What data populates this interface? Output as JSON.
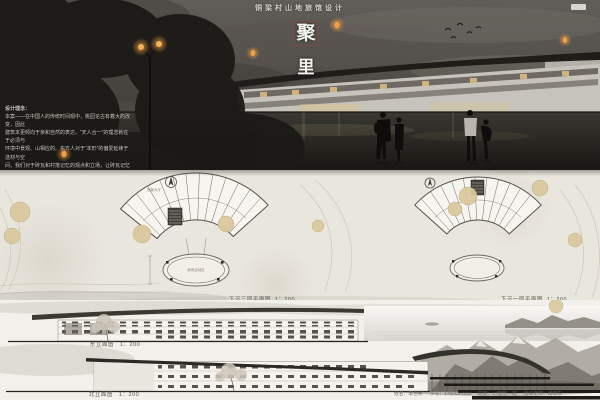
{
  "header": {
    "subtitle": "铜梁村山地旅馆设计",
    "title_char_top": "聚",
    "title_char_bottom": "里"
  },
  "design_notes": {
    "heading": "设计理念：",
    "lines": [
      "本案——在中国人的传统时间观中，桃园论古有着大的改变，因此",
      "建筑本更倾向于亲和自然的表达。“天人合一”的理念就在于必须与",
      "环境中景观、山相应的。东方人对于“本形”的偏爱延续于选材与空",
      "间，我们对于砖瓦和村落记忆的观点和立场，让砖瓦记忆存载场地，",
      "留了原来的事物，也加入了新鲜的血液，革新着乡村原有",
      "的风味，融入了现代的便捷；这些在设计中有了很多意义。"
    ]
  },
  "plans": {
    "left": {
      "label": "下沉三层平面图",
      "scale": "1：200",
      "room_label": "观景大厅",
      "courtyard_label": "休闲活动区"
    },
    "right": {
      "label": "下沉一层平面图",
      "scale": "1：200"
    }
  },
  "elevations": {
    "east": {
      "label": "东立面图",
      "scale": "1：200"
    },
    "north": {
      "label": "北立面图",
      "scale": "1：200"
    }
  },
  "footer": {
    "credits": [
      "姓名：李世彬",
      "学号：1760010108",
      "班级：17建筑一班",
      "指导老师：杨晓东"
    ]
  },
  "colors": {
    "lantern_glow": "#e8953c",
    "title_box_red": "#a8392e",
    "paper": "#e9e6de",
    "ink_dark": "#2f2d28",
    "tree_tan": "#d9c79c"
  }
}
